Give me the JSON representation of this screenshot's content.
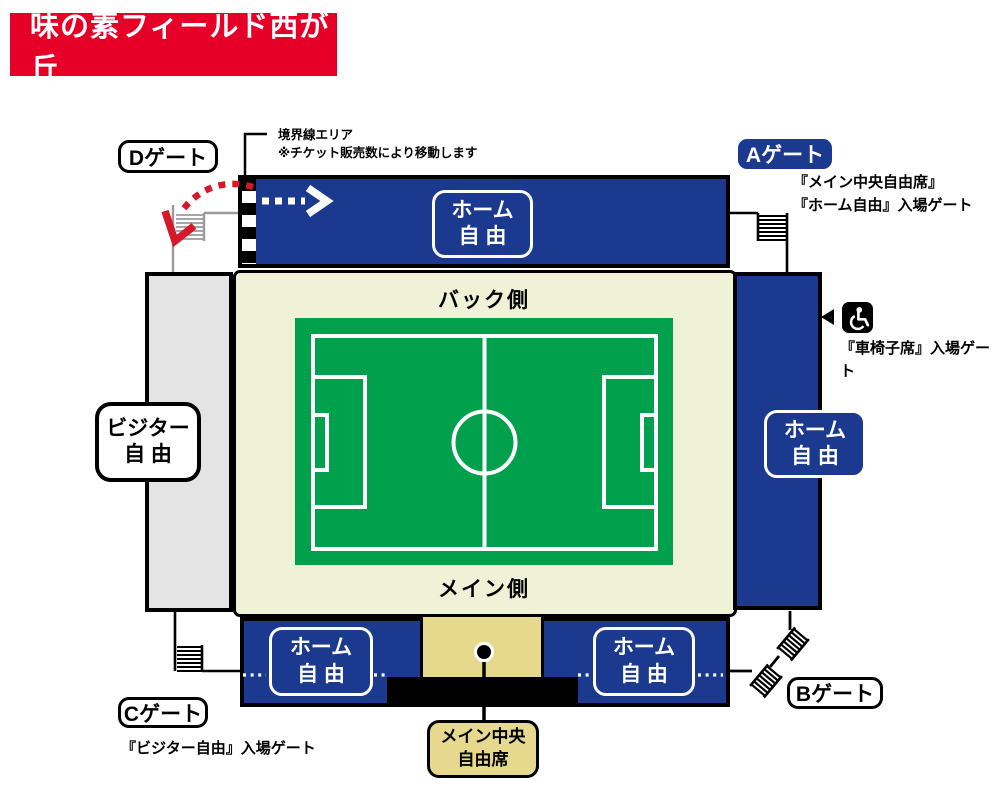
{
  "title": "味の素フィールド西が丘",
  "gates": {
    "a": {
      "label": "Aゲート",
      "note_line1": "『メイン中央自由席』",
      "note_line2": "『ホーム自由』入場ゲート"
    },
    "b": {
      "label": "Bゲート"
    },
    "c": {
      "label": "Cゲート",
      "note": "『ビジター自由』入場ゲート"
    },
    "d": {
      "label": "Dゲート"
    }
  },
  "boundary_note": {
    "line1": "境界線エリア",
    "line2": "※チケット販売数により移動します"
  },
  "wheelchair_note": "『車椅子席』入場ゲート",
  "stands": {
    "top": {
      "line1": "ホーム",
      "line2": "自 由"
    },
    "right": {
      "line1": "ホーム",
      "line2": "自 由"
    },
    "left": {
      "line1": "ビジター",
      "line2": "自 由"
    },
    "bottom_left": {
      "line1": "ホーム",
      "line2": "自 由"
    },
    "bottom_right": {
      "line1": "ホーム",
      "line2": "自 由"
    }
  },
  "main_center_seat": {
    "line1": "メイン中央",
    "line2": "自由席"
  },
  "field": {
    "back": "バック側",
    "main": "メイン側"
  },
  "colors": {
    "brand_red": "#e60027",
    "stand_blue": "#1b3a8f",
    "pitch_green": "#00a04d",
    "infield_cream": "#f0f2d8",
    "center_tan": "#e6d88c",
    "visitor_gray": "#e4e4e4",
    "arrow_red": "#d7182b"
  }
}
